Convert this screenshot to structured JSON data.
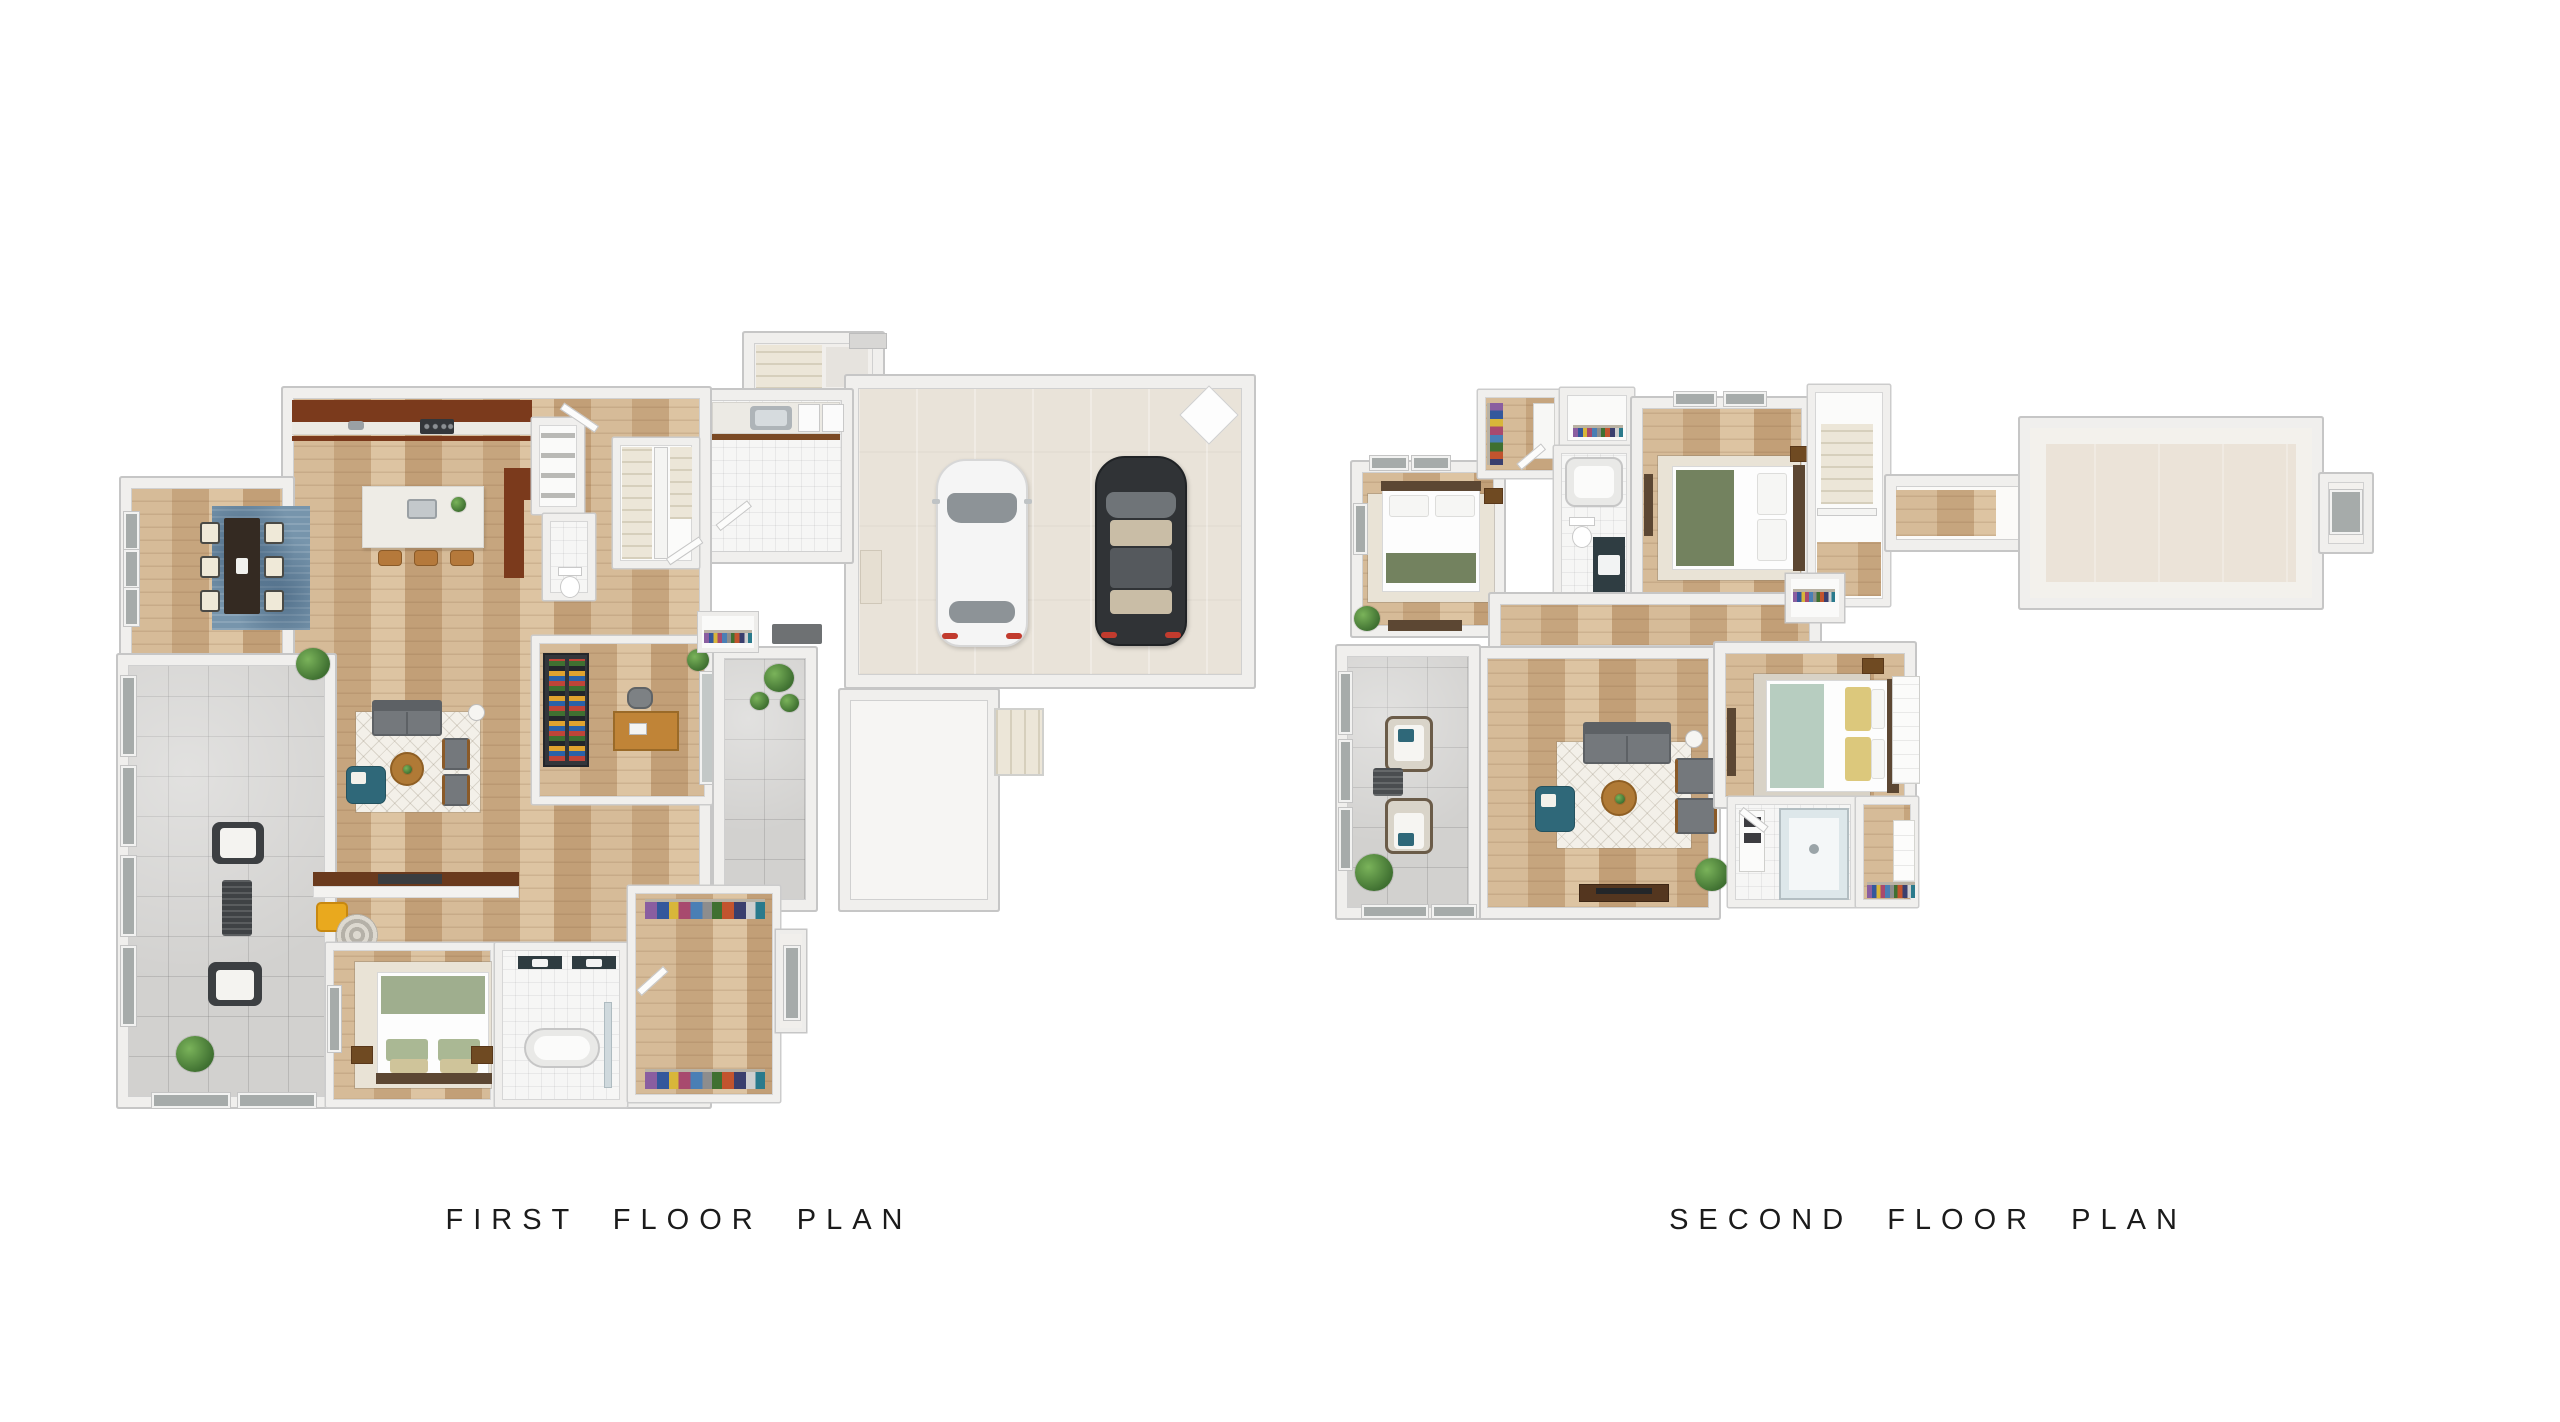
{
  "captions": {
    "first_floor": "FIRST FLOOR PLAN",
    "second_floor": "SECOND FLOOR PLAN"
  },
  "plans": {
    "first_floor": {
      "rooms": [
        "front-porch",
        "garage",
        "mudroom-laundry",
        "entry",
        "stairs",
        "pantry",
        "powder-room",
        "kitchen",
        "dining-nook",
        "living-room",
        "office",
        "covered-patio",
        "back-patio",
        "back-porch",
        "bedroom",
        "bathroom",
        "walk-in-closet"
      ],
      "vehicles": [
        "white-car",
        "black-car"
      ]
    },
    "second_floor": {
      "rooms": [
        "walk-in-closet",
        "linen-closet",
        "bedroom-2",
        "hall-bathroom",
        "bedroom-3",
        "stairs",
        "hallway",
        "loft-living",
        "deck",
        "master-bedroom",
        "master-bathroom",
        "master-closet",
        "bonus-room"
      ]
    }
  },
  "palette": {
    "background": "#ffffff",
    "wall": "#f0efed",
    "wall_outline": "#c6c6c6",
    "wood_floor": "#cfb493",
    "gray_tile": "#d2d1cf",
    "white_tile": "#f6f6f5",
    "garage_floor": "#e9e3d9",
    "bonus_floor": "#ebe3d8",
    "accent_teal": "#2f6879",
    "accent_yellow": "#e9a91e",
    "accent_sage": "#8fa07e",
    "accent_seafoam": "#b7cdc0",
    "rug_blue": "#7795ac",
    "cabinet_brown": "#7b3a1c",
    "car_black": "#303336",
    "car_white": "#f5f5f5",
    "text": "#1b1b1b"
  }
}
